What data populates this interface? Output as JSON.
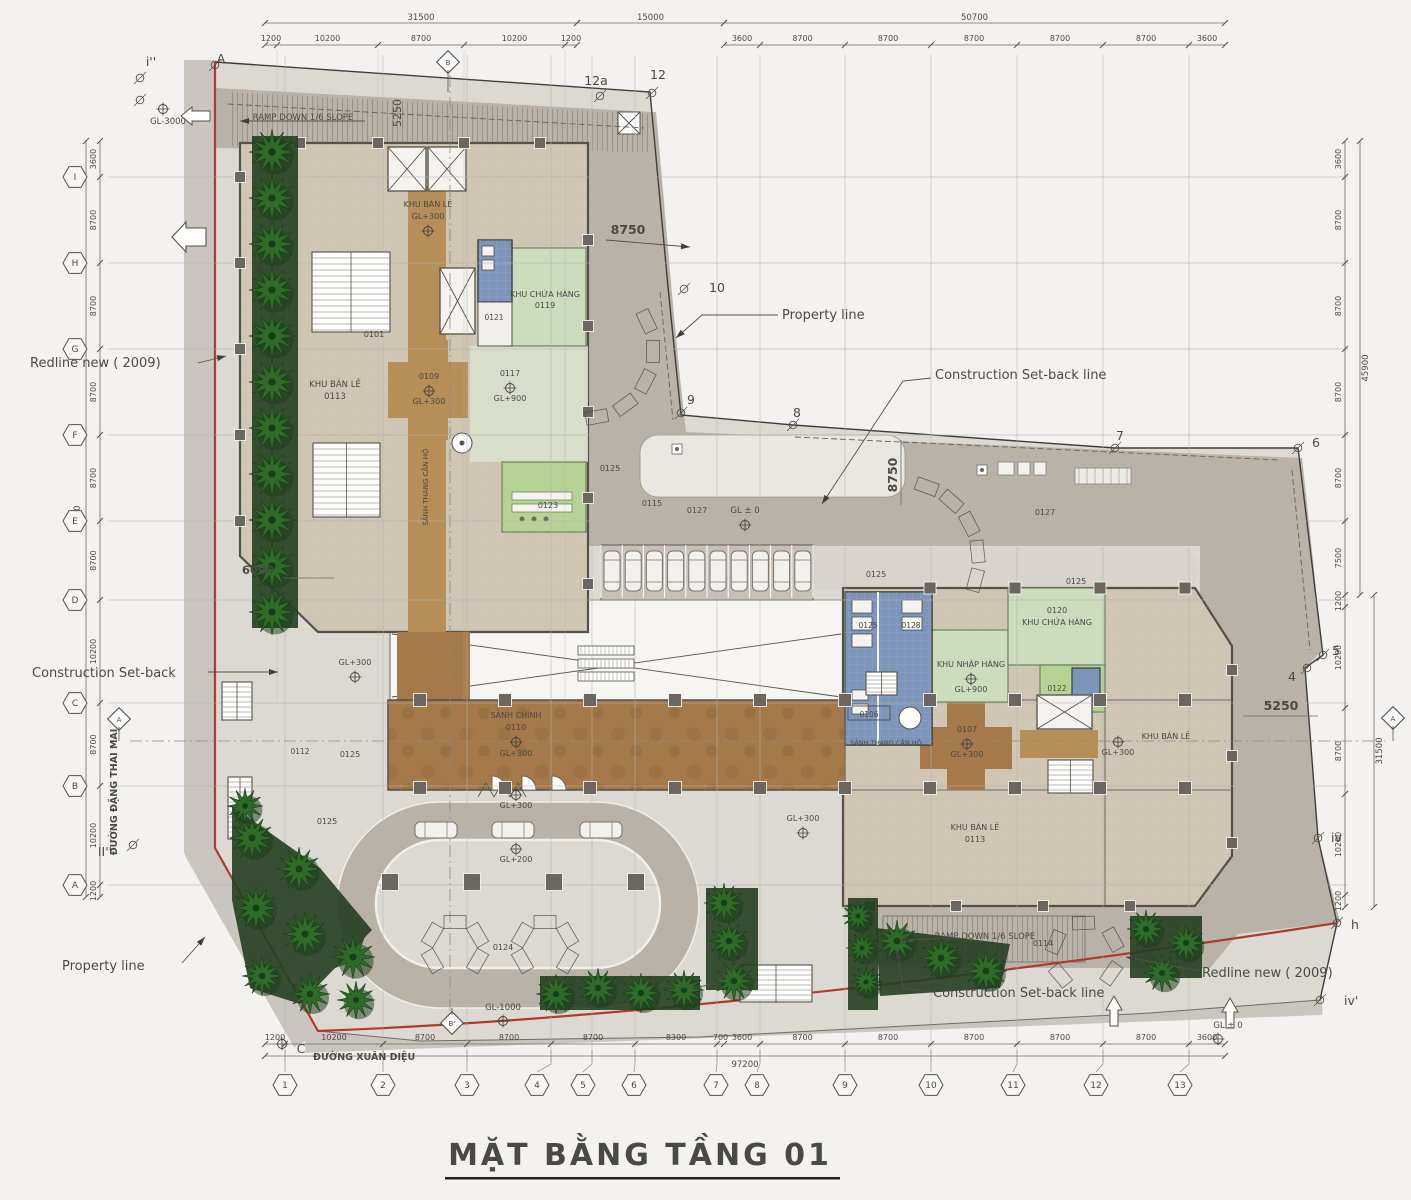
{
  "title": "MẶT BẰNG TẦNG 01",
  "streets": {
    "left": "ĐƯỜNG ĐẶNG THAI MAI",
    "bottom": "ĐƯỜNG XUÂN DIỆU"
  },
  "callouts": {
    "redline_left": "Redline new ( 2009)",
    "redline_right": "Redline new ( 2009)",
    "property_top": "Property line",
    "property_bottom": "Property line",
    "setback_left": "Construction Set-back",
    "setback_right": "Construction Set-back line",
    "setback_bottom": "Construction Set-back line",
    "ramp_top": "RAMP DOWN 1/6 SLOPE",
    "ramp_bottom": "RAMP DOWN 1/6 SLOPE",
    "gl_m3000": "GL-3000",
    "gl_m1000": "GL-1000",
    "gl_zero": "GL ± 0"
  },
  "key_dims": {
    "d8750": "8750",
    "d5250": "5250",
    "d6000": "6000"
  },
  "levels": {
    "gl300": "GL+300",
    "gl900": "GL+900",
    "gl200": "GL+200"
  },
  "rooms": {
    "retail_top_name": "KHU BÁN LẺ",
    "retail_nw_name": "KHU BÁN LẺ",
    "retail_nw_code": "0113",
    "storage_nw_name": "KHU CHỨA HÀNG",
    "storage_nw_code": "0119",
    "stair_nw": "0101",
    "r0121": "0121",
    "core_nw": "0109",
    "court": "0117",
    "corridor_name": "SẢNH THANG CĂN HỘ",
    "r0123": "0123",
    "lobby_name": "SẢNH CHÍNH",
    "lobby_code": "0110",
    "stair_w": "0112",
    "storage_ne_name": "KHU CHỨA HÀNG",
    "storage_ne_code": "0120",
    "loading_name": "KHU NHẬP HÀNG",
    "r0122": "0122",
    "r0106": "0106",
    "core_se": "0107",
    "se_lobby_name": "SẢNH THANG CĂN HỘ",
    "retail_se_name": "KHU BÁN LẺ",
    "retail_se_code": "0113",
    "retail_e_name": "KHU BÁN LẺ",
    "wc_a": "0125",
    "wc_b": "0128",
    "c0114": "0114",
    "c0115": "0115",
    "c0124": "0124",
    "c0125": "0125",
    "c0126": "0126",
    "c0127": "0127"
  },
  "grid": {
    "rows": [
      "I",
      "H",
      "G",
      "F",
      "E",
      "D",
      "C",
      "B",
      "A"
    ],
    "cols": [
      "1",
      "2",
      "3",
      "4",
      "5",
      "6",
      "7",
      "8",
      "9",
      "10",
      "11",
      "12",
      "13"
    ]
  },
  "boundary_points": {
    "i2": "i''",
    "a": "A",
    "p12a": "12a",
    "p12": "12",
    "p10": "10",
    "p9": "9",
    "p8": "8",
    "p7": "7",
    "p6": "6",
    "p5": "5",
    "p4": "4",
    "piv": "iv",
    "ph": "h",
    "piv2": "iv'",
    "ii2": "II''",
    "c": "C",
    "sec_a": "A",
    "sec_b": "B",
    "sec_b2": "B'"
  },
  "dims": {
    "top_left": {
      "total": "31500",
      "segments": [
        "1200",
        "10200",
        "8700",
        "10200",
        "1200"
      ]
    },
    "top_mid_total": "15000",
    "top_right": {
      "total": "50700",
      "segments": [
        "3600",
        "8700",
        "8700",
        "8700",
        "8700",
        "8700",
        "3600"
      ]
    },
    "left": {
      "total": "77400",
      "segments": [
        "3600",
        "8700",
        "8700",
        "8700",
        "8700",
        "8700",
        "10200",
        "8700",
        "10200",
        "1200"
      ]
    },
    "right": {
      "total_upper": "45900",
      "total_lower": "31500",
      "segments": [
        "3600",
        "8700",
        "8700",
        "8700",
        "8700",
        "7500",
        "1200",
        "10200",
        "8700",
        "10200",
        "1200"
      ]
    },
    "bottom": {
      "total": "97200",
      "segments": [
        "1200",
        "10200",
        "8700",
        "8700",
        "8700",
        "8300",
        "700",
        "3600",
        "8700",
        "8700",
        "8700",
        "8700",
        "8700",
        "3600"
      ]
    }
  },
  "colors": {
    "redline": "#b03a2e",
    "road": "#b9b2a9",
    "pavement": "#dcd9d3",
    "floor": "#cfc6b4",
    "lobby": "#a6794a",
    "core": "#b68e58",
    "green": "#ccdcbd",
    "green_bright": "#b6d295",
    "blue": "#7e95ba",
    "tree": "#2e6b28"
  }
}
